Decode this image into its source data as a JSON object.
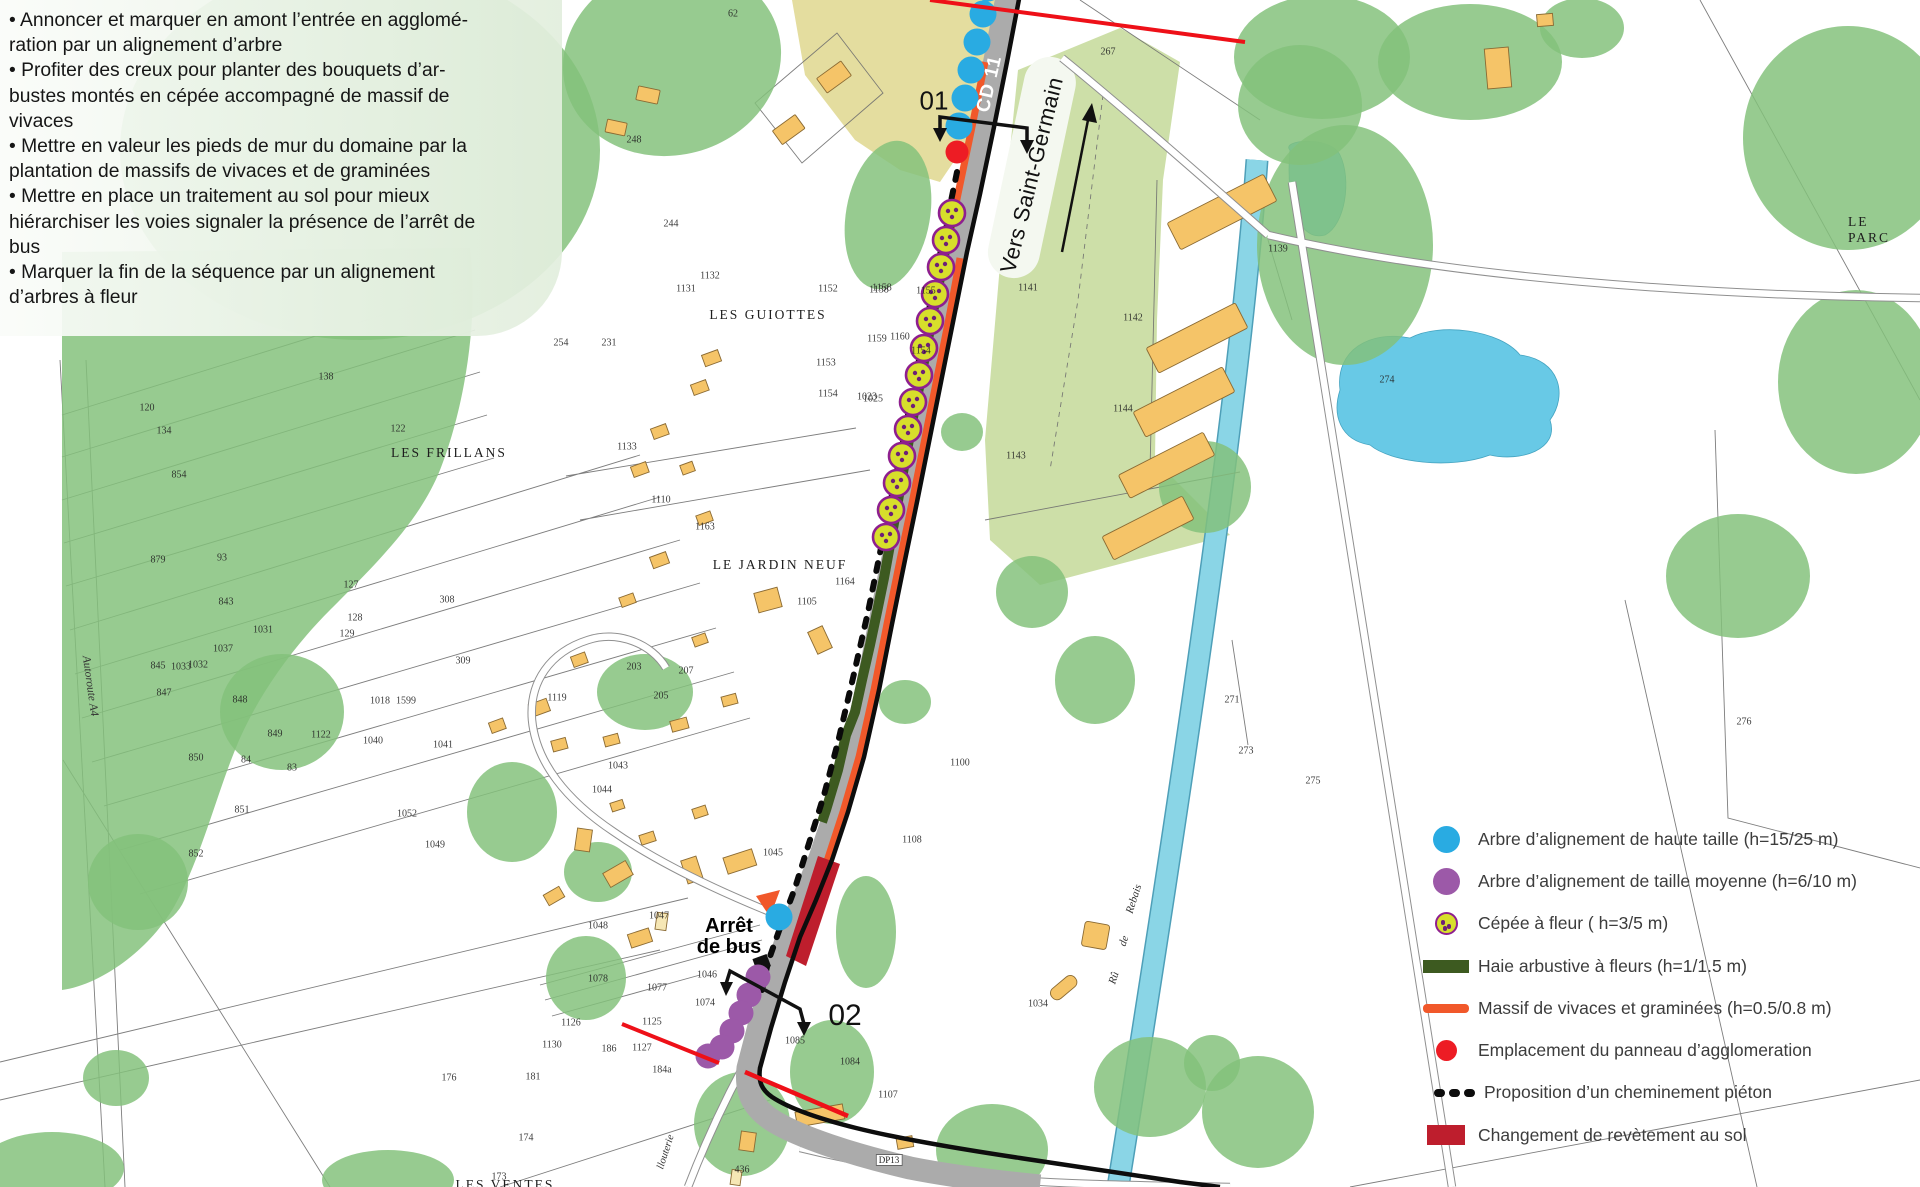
{
  "notes": {
    "bullets": [
      "• Annoncer et marquer en amont l’entrée en agglomé-\nration par un alignement d’arbre",
      "• Profiter des creux pour planter des bouquets d’ar-\nbustes montés en cépée accompagné de massif de\nvivaces",
      "• Mettre en valeur les pieds de mur du domaine par la\nplantation de massifs de vivaces et de graminées",
      "• Mettre en place un traitement au sol pour mieux\nhiérarchiser les voies signaler la présence de l’arrêt de\nbus",
      "• Marquer la fin de la séquence par un alignement\nd’arbres à fleur"
    ]
  },
  "legend": {
    "items": [
      {
        "swatch": "circle-blue",
        "label": "Arbre d’alignement de haute taille (h=15/25 m)"
      },
      {
        "swatch": "circle-purple",
        "label": "Arbre d’alignement de taille moyenne (h=6/10 m)"
      },
      {
        "swatch": "circle-cepee",
        "label": "Cépée à fleur ( h=3/5 m)"
      },
      {
        "swatch": "bar-green",
        "label": "Haie arbustive à fleurs (h=1/1.5 m)"
      },
      {
        "swatch": "bar-orange",
        "label": "Massif de vivaces et graminées (h=0.5/0.8 m)"
      },
      {
        "swatch": "dot-red",
        "label": "Emplacement du panneau d’agglomeration"
      },
      {
        "swatch": "dots-black",
        "label": "Proposition d’un cheminement piéton"
      },
      {
        "swatch": "rect-darkred",
        "label": "Changement de revètement au sol"
      }
    ]
  },
  "map": {
    "labels": {
      "cd11": {
        "text": "CD 11"
      },
      "vers": {
        "text": "Vers Saint-Germain"
      },
      "sec01": {
        "text": "01"
      },
      "sec02": {
        "text": "02"
      },
      "arret": {
        "text": "Arrêt\nde bus"
      },
      "guiottes": {
        "text": "LES GUIOTTES"
      },
      "frillans": {
        "text": "LES FRILLANS"
      },
      "jardin": {
        "text": "LE JARDIN NEUF"
      },
      "parc": {
        "text": "LE PARC"
      },
      "ventes": {
        "text": "LES VENTES"
      },
      "autoroute": {
        "text": "Autoroute A4"
      },
      "llouterie": {
        "text": "llouterie"
      },
      "dp13": {
        "text": "DP13"
      },
      "ru1": {
        "text": "Rû"
      },
      "ru2": {
        "text": "de"
      },
      "ru3": {
        "text": "Rebais"
      }
    },
    "colors": {
      "high_tree": "#29abe2",
      "medium_tree": "#9c59a8",
      "cepee": "#d7df2b",
      "cepee_ring": "#8e1f8f",
      "cepee_dot": "#6d2077",
      "hedge": "#3d5a20",
      "massif": "#f1582a",
      "panneau": "#ed1c24",
      "revetement": "#be1e2d",
      "water": "#8ad5e6",
      "vegetation": "#83c17b",
      "field": "#cddfa8",
      "building": "#f5c468",
      "road": "#ababab",
      "boundary_red": "#ee1018",
      "boundary_black": "#0d0d0d"
    },
    "blue_trees": [
      [
        988,
        -12
      ],
      [
        983,
        14
      ],
      [
        977,
        42
      ],
      [
        971,
        70
      ],
      [
        965,
        98
      ],
      [
        959,
        126
      ],
      [
        779,
        917
      ]
    ],
    "red_dots": [
      [
        957,
        152
      ]
    ],
    "purple_trees": [
      [
        758,
        977
      ],
      [
        749,
        995
      ],
      [
        741,
        1013
      ],
      [
        732,
        1031
      ],
      [
        722,
        1047
      ],
      [
        708,
        1056
      ]
    ],
    "cepees": [
      [
        952,
        213
      ],
      [
        946,
        240
      ],
      [
        941,
        267
      ],
      [
        935,
        294
      ],
      [
        930,
        321
      ],
      [
        924,
        348
      ],
      [
        919,
        375
      ],
      [
        913,
        402
      ],
      [
        908,
        429
      ],
      [
        902,
        456
      ],
      [
        897,
        483
      ],
      [
        891,
        510
      ],
      [
        886,
        537
      ]
    ],
    "parcel_numbers": [
      {
        "t": "62",
        "x": 733,
        "y": 14
      },
      {
        "t": "267",
        "x": 1108,
        "y": 52
      },
      {
        "t": "248",
        "x": 634,
        "y": 140
      },
      {
        "t": "244",
        "x": 671,
        "y": 224
      },
      {
        "t": "1152",
        "x": 828,
        "y": 289
      },
      {
        "t": "1138",
        "x": 879,
        "y": 290
      },
      {
        "t": "1131",
        "x": 686,
        "y": 289
      },
      {
        "t": "1132",
        "x": 710,
        "y": 276
      },
      {
        "t": "254",
        "x": 561,
        "y": 343
      },
      {
        "t": "231",
        "x": 609,
        "y": 343
      },
      {
        "t": "1153",
        "x": 826,
        "y": 363
      },
      {
        "t": "1154",
        "x": 828,
        "y": 394
      },
      {
        "t": "1023",
        "x": 867,
        "y": 397
      },
      {
        "t": "1158",
        "x": 882,
        "y": 288
      },
      {
        "t": "1155",
        "x": 926,
        "y": 291
      },
      {
        "t": "1159",
        "x": 877,
        "y": 339
      },
      {
        "t": "1160",
        "x": 900,
        "y": 337
      },
      {
        "t": "1154",
        "x": 921,
        "y": 351
      },
      {
        "t": "1025",
        "x": 873,
        "y": 399
      },
      {
        "t": "1141",
        "x": 1028,
        "y": 288
      },
      {
        "t": "1142",
        "x": 1133,
        "y": 318
      },
      {
        "t": "1144",
        "x": 1123,
        "y": 409
      },
      {
        "t": "1143",
        "x": 1016,
        "y": 456
      },
      {
        "t": "1139",
        "x": 1278,
        "y": 249
      },
      {
        "t": "274",
        "x": 1387,
        "y": 380
      },
      {
        "t": "273",
        "x": 1246,
        "y": 751
      },
      {
        "t": "275",
        "x": 1313,
        "y": 781
      },
      {
        "t": "276",
        "x": 1744,
        "y": 722
      },
      {
        "t": "271",
        "x": 1232,
        "y": 700
      },
      {
        "t": "134",
        "x": 164,
        "y": 431
      },
      {
        "t": "120",
        "x": 147,
        "y": 408
      },
      {
        "t": "122",
        "x": 398,
        "y": 429
      },
      {
        "t": "138",
        "x": 326,
        "y": 377
      },
      {
        "t": "854",
        "x": 179,
        "y": 475
      },
      {
        "t": "879",
        "x": 158,
        "y": 560
      },
      {
        "t": "93",
        "x": 222,
        "y": 558
      },
      {
        "t": "843",
        "x": 226,
        "y": 602
      },
      {
        "t": "1031",
        "x": 263,
        "y": 630
      },
      {
        "t": "1032",
        "x": 198,
        "y": 665
      },
      {
        "t": "845",
        "x": 158,
        "y": 666
      },
      {
        "t": "847",
        "x": 164,
        "y": 693
      },
      {
        "t": "848",
        "x": 240,
        "y": 700
      },
      {
        "t": "849",
        "x": 275,
        "y": 734
      },
      {
        "t": "850",
        "x": 196,
        "y": 758
      },
      {
        "t": "84",
        "x": 246,
        "y": 760
      },
      {
        "t": "83",
        "x": 292,
        "y": 768
      },
      {
        "t": "851",
        "x": 242,
        "y": 810
      },
      {
        "t": "852",
        "x": 196,
        "y": 854
      },
      {
        "t": "308",
        "x": 447,
        "y": 600
      },
      {
        "t": "309",
        "x": 463,
        "y": 661
      },
      {
        "t": "127",
        "x": 351,
        "y": 585
      },
      {
        "t": "128",
        "x": 355,
        "y": 618
      },
      {
        "t": "129",
        "x": 347,
        "y": 634
      },
      {
        "t": "1133",
        "x": 627,
        "y": 447
      },
      {
        "t": "1110",
        "x": 661,
        "y": 500
      },
      {
        "t": "1163",
        "x": 705,
        "y": 527
      },
      {
        "t": "1164",
        "x": 845,
        "y": 582
      },
      {
        "t": "1105",
        "x": 807,
        "y": 602
      },
      {
        "t": "203",
        "x": 634,
        "y": 667
      },
      {
        "t": "205",
        "x": 661,
        "y": 696
      },
      {
        "t": "207",
        "x": 686,
        "y": 671
      },
      {
        "t": "1119",
        "x": 557,
        "y": 698
      },
      {
        "t": "1122",
        "x": 321,
        "y": 735
      },
      {
        "t": "1018",
        "x": 380,
        "y": 701
      },
      {
        "t": "1599",
        "x": 406,
        "y": 701
      },
      {
        "t": "1037",
        "x": 223,
        "y": 649
      },
      {
        "t": "1033",
        "x": 181,
        "y": 667
      },
      {
        "t": "1040",
        "x": 373,
        "y": 741
      },
      {
        "t": "1041",
        "x": 443,
        "y": 745
      },
      {
        "t": "1043",
        "x": 618,
        "y": 766
      },
      {
        "t": "1044",
        "x": 602,
        "y": 790
      },
      {
        "t": "1052",
        "x": 407,
        "y": 814
      },
      {
        "t": "1049",
        "x": 435,
        "y": 845
      },
      {
        "t": "1045",
        "x": 773,
        "y": 853
      },
      {
        "t": "1047",
        "x": 659,
        "y": 916
      },
      {
        "t": "1048",
        "x": 598,
        "y": 926
      },
      {
        "t": "1046",
        "x": 707,
        "y": 975
      },
      {
        "t": "1074",
        "x": 705,
        "y": 1003
      },
      {
        "t": "1077",
        "x": 657,
        "y": 988
      },
      {
        "t": "1078",
        "x": 598,
        "y": 979
      },
      {
        "t": "1125",
        "x": 652,
        "y": 1022
      },
      {
        "t": "1126",
        "x": 571,
        "y": 1023
      },
      {
        "t": "1130",
        "x": 552,
        "y": 1045
      },
      {
        "t": "186",
        "x": 609,
        "y": 1049
      },
      {
        "t": "1127",
        "x": 642,
        "y": 1048
      },
      {
        "t": "1085",
        "x": 795,
        "y": 1041
      },
      {
        "t": "1084",
        "x": 850,
        "y": 1062
      },
      {
        "t": "176",
        "x": 449,
        "y": 1078
      },
      {
        "t": "181",
        "x": 533,
        "y": 1077
      },
      {
        "t": "174",
        "x": 526,
        "y": 1138
      },
      {
        "t": "173",
        "x": 499,
        "y": 1177
      },
      {
        "t": "184a",
        "x": 662,
        "y": 1070
      },
      {
        "t": "436",
        "x": 742,
        "y": 1170
      },
      {
        "t": "1034",
        "x": 1038,
        "y": 1004
      },
      {
        "t": "1107",
        "x": 888,
        "y": 1095
      },
      {
        "t": "1108",
        "x": 912,
        "y": 840
      },
      {
        "t": "1100",
        "x": 960,
        "y": 763
      }
    ]
  }
}
